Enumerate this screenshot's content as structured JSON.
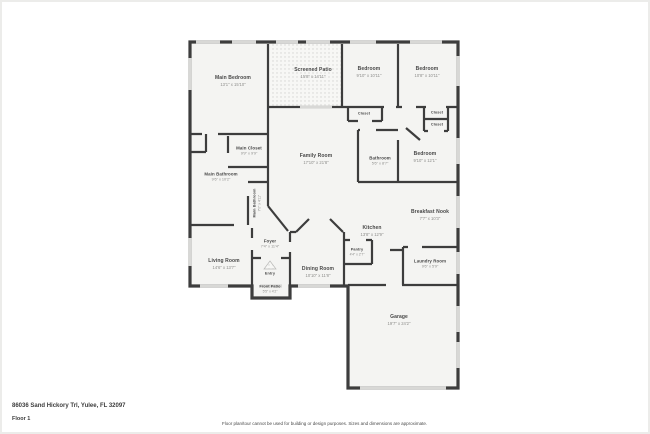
{
  "footer": {
    "address": "86036 Sand Hickory Trl, Yulee, FL 32097",
    "floor_label": "Floor 1",
    "disclaimer": "Floor plan/tour cannot be used for building or design purposes. Sizes and dimensions are approximate."
  },
  "rooms": {
    "main_bedroom": {
      "name": "Main Bedroom",
      "dims": "13'1\" x 15'10\""
    },
    "screened_patio": {
      "name": "Screened Patio",
      "dims": "15'8\" x 14'11\""
    },
    "bedroom_top_mid": {
      "name": "Bedroom",
      "dims": "9'10\" x 10'11\""
    },
    "bedroom_top_right": {
      "name": "Bedroom",
      "dims": "10'8\" x 10'11\""
    },
    "closet_mid": {
      "name": "Closet"
    },
    "closet_r1": {
      "name": "Closet"
    },
    "closet_r2": {
      "name": "Closet"
    },
    "main_closet": {
      "name": "Main Closet",
      "dims": "9'9\" x 9'9\""
    },
    "main_bathroom": {
      "name": "Main Bathroom",
      "dims": "9'6\" x 10'2\""
    },
    "main_bathroom_wc": {
      "name": "Main Bathroom",
      "dims": "7'0\" x 4'11\""
    },
    "family_room": {
      "name": "Family Room",
      "dims": "17'10\" x 21'8\""
    },
    "bathroom": {
      "name": "Bathroom",
      "dims": "5'6\" x 8'7\""
    },
    "bedroom_mid_right": {
      "name": "Bedroom",
      "dims": "9'10\" x 12'1\""
    },
    "breakfast_nook": {
      "name": "Breakfast Nook",
      "dims": "7'7\" x 10'3\""
    },
    "kitchen": {
      "name": "Kitchen",
      "dims": "13'8\" x 12'9\""
    },
    "pantry": {
      "name": "Pantry",
      "dims": "4'4\" x 2'7\""
    },
    "laundry_room": {
      "name": "Laundry Room",
      "dims": "9'6\" x 5'9\""
    },
    "foyer": {
      "name": "Foyer",
      "dims": "7'4\" x 11'4\""
    },
    "living_room": {
      "name": "Living Room",
      "dims": "14'6\" x 13'7\""
    },
    "dining_room": {
      "name": "Dining Room",
      "dims": "10'10\" x 11'8\""
    },
    "entry": {
      "name": "Entry"
    },
    "front_patio": {
      "name": "Front Patio",
      "dims": "5'5\" x 4'2\""
    },
    "garage": {
      "name": "Garage",
      "dims": "19'7\" x 24'2\""
    }
  },
  "colors": {
    "wall": "#3d3d3d",
    "room_fill": "#f4f4f2",
    "window": "#d8d8d6",
    "page": "#ffffff"
  }
}
